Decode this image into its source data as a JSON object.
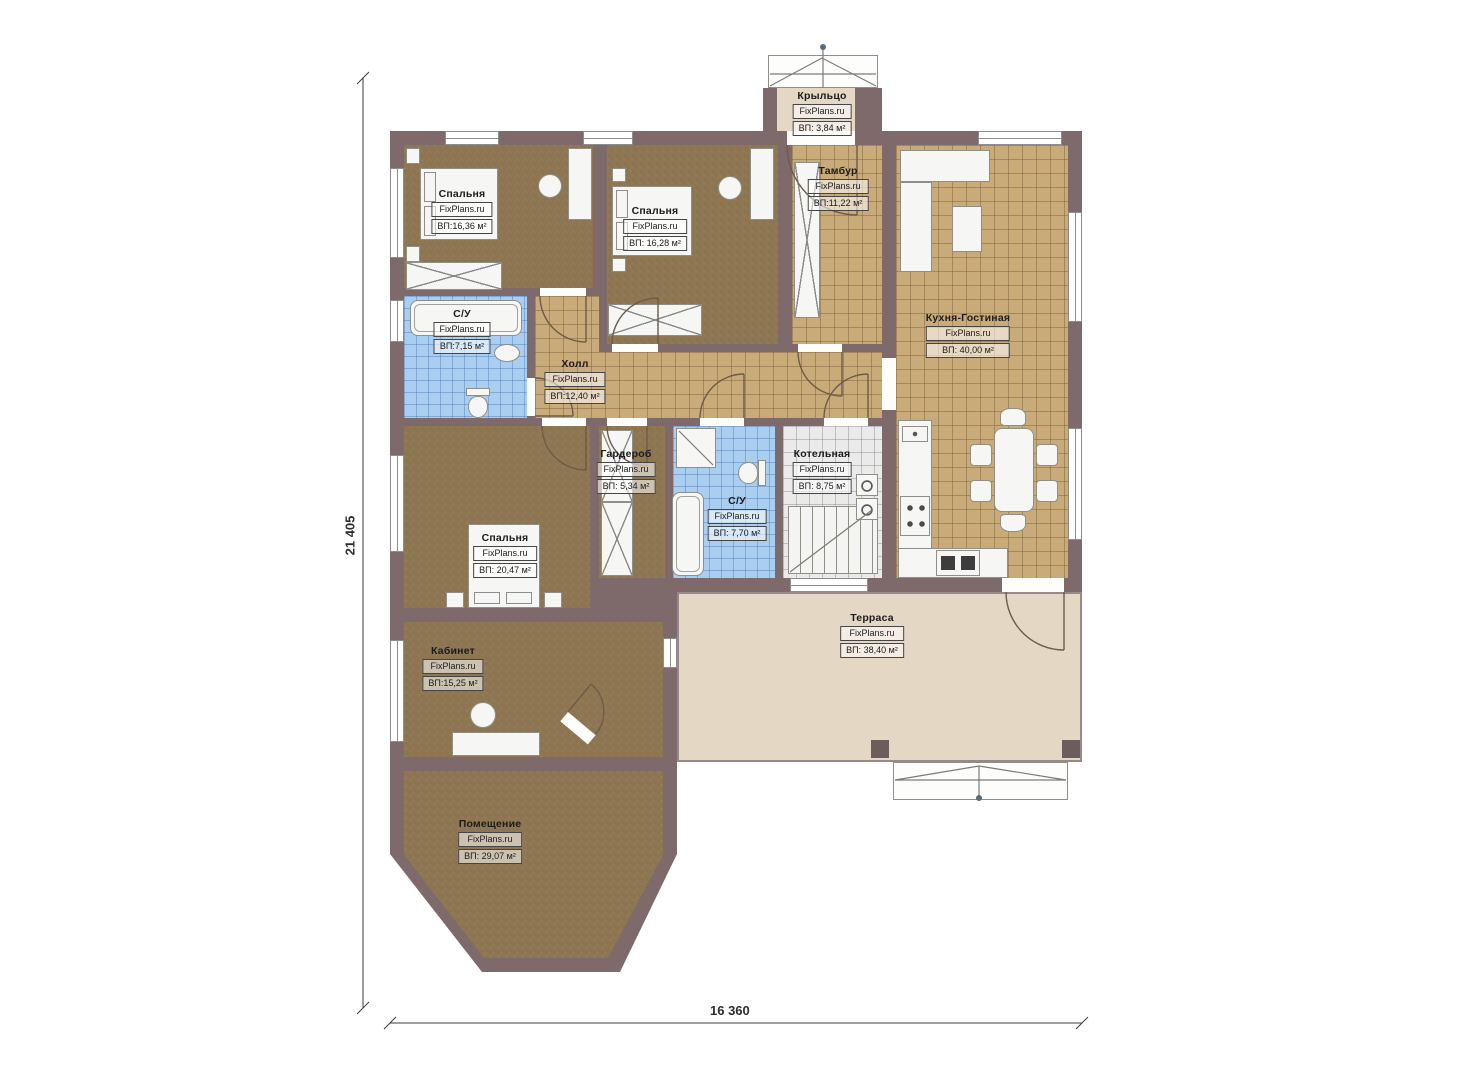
{
  "watermark": "FixPlans.ru",
  "dimensions": {
    "vertical": "21 405",
    "horizontal": "16 360"
  },
  "rooms": [
    {
      "key": "porch",
      "name": "Крыльцо",
      "brand": "FixPlans.ru",
      "area": "ВП: 3,84 м²"
    },
    {
      "key": "bedroom-1",
      "name": "Спальня",
      "brand": "FixPlans.ru",
      "area": "ВП:16,36 м²"
    },
    {
      "key": "bedroom-2",
      "name": "Спальня",
      "brand": "FixPlans.ru",
      "area": "ВП: 16,28 м²"
    },
    {
      "key": "tambour",
      "name": "Тамбур",
      "brand": "FixPlans.ru",
      "area": "ВП:11,22 м²"
    },
    {
      "key": "kitchen-living",
      "name": "Кухня-Гостиная",
      "brand": "FixPlans.ru",
      "area": "ВП: 40,00 м²"
    },
    {
      "key": "bathroom-1",
      "name": "С/У",
      "brand": "FixPlans.ru",
      "area": "ВП:7,15 м²"
    },
    {
      "key": "hall",
      "name": "Холл",
      "brand": "FixPlans.ru",
      "area": "ВП:12,40 м²"
    },
    {
      "key": "wardrobe-room",
      "name": "Гардероб",
      "brand": "FixPlans.ru",
      "area": "ВП: 5,34 м²"
    },
    {
      "key": "bathroom-2",
      "name": "С/У",
      "brand": "FixPlans.ru",
      "area": "ВП: 7,70 м²"
    },
    {
      "key": "boiler-room",
      "name": "Котельная",
      "brand": "FixPlans.ru",
      "area": "ВП: 8,75 м²"
    },
    {
      "key": "bedroom-3",
      "name": "Спальня",
      "brand": "FixPlans.ru",
      "area": "ВП: 20,47 м²"
    },
    {
      "key": "terrace",
      "name": "Терраса",
      "brand": "FixPlans.ru",
      "area": "ВП: 38,40 м²"
    },
    {
      "key": "office",
      "name": "Кабинет",
      "brand": "FixPlans.ru",
      "area": "ВП:15,25 м²"
    },
    {
      "key": "utility-room",
      "name": "Помещение",
      "brand": "FixPlans.ru",
      "area": "ВП: 29,07 м²"
    }
  ],
  "colors": {
    "wall": "#7e6a6a",
    "floor_wood": "#8c7550",
    "tile_beige": "#c9ab7a",
    "tile_blue": "#aaceef",
    "tile_grey": "#eaeaea",
    "terrace": "#e4d8c5",
    "furniture": "#f6f6f4"
  }
}
